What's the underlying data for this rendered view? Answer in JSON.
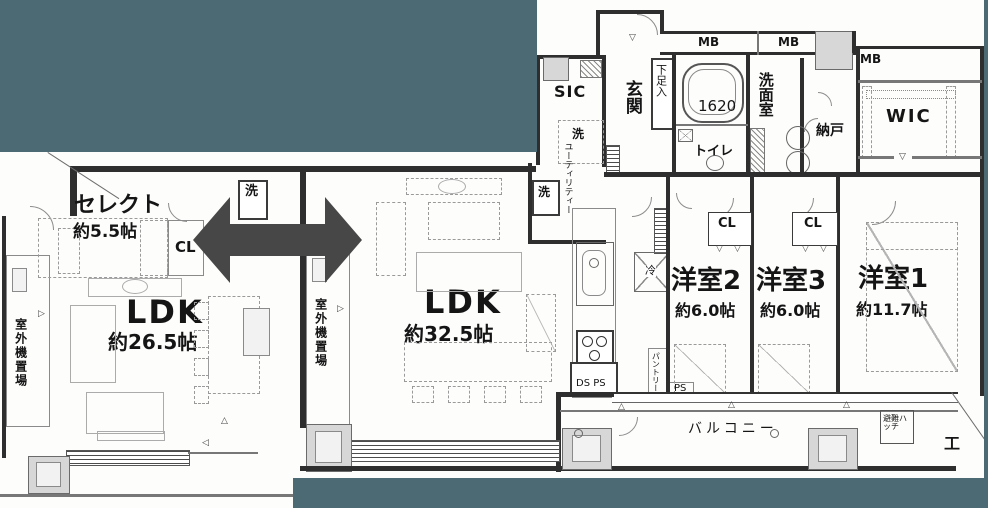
{
  "colors": {
    "background": "#4B6A73",
    "arrow": "#474747",
    "wall": "#2e2e2e",
    "paper": "#FDFDFC",
    "gray_fill": "#D7D7D7"
  },
  "left_plan": {
    "select_room": {
      "name": "セレクト",
      "size": "約5.5帖"
    },
    "ldk": {
      "name": "LDK",
      "size": "約26.5帖"
    },
    "labels": {
      "closet": "CL",
      "washer": "洗",
      "outdoor_unit": "室外機置場"
    }
  },
  "right_plan": {
    "ldk": {
      "name": "LDK",
      "size": "約32.5帖"
    },
    "bedroom2": {
      "name": "洋室2",
      "size": "約6.0帖"
    },
    "bedroom3": {
      "name": "洋室3",
      "size": "約6.0帖"
    },
    "bedroom1": {
      "name": "洋室1",
      "size": "約11.7帖"
    },
    "labels": {
      "sic": "SIC",
      "entrance": "玄関",
      "shoe_cabinet": "下足入",
      "bath_size": "1620",
      "mb": "MB",
      "toilet": "トイレ",
      "washroom": "洗面室",
      "storeroom": "納戸",
      "wic": "WIC",
      "washer": "洗",
      "utility": "ユーティリティー",
      "pantry": "パントリー",
      "refrigerator": "冷",
      "closet": "CL",
      "outdoor_unit": "室外機置場",
      "balcony": "バルコニー",
      "ds_ps": "DS PS",
      "ps": "PS",
      "evac_hatch": "避難ハッチ",
      "steel_column": "工"
    }
  },
  "marks": {
    "tri_down": "▽",
    "tri_up": "△",
    "tri_right": "▷",
    "tri_left": "◁"
  }
}
